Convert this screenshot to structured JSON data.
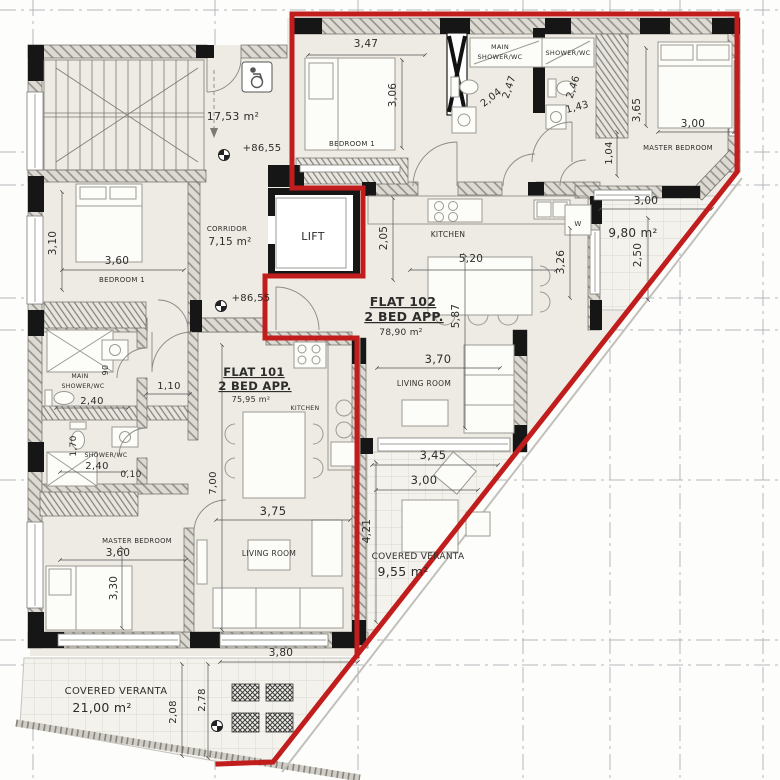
{
  "flats": [
    {
      "name": "FLAT 101",
      "type": "2 BED APP.",
      "area": "75,95 m²",
      "highlighted": false
    },
    {
      "name": "FLAT 102",
      "type": "2 BED APP.",
      "area": "78,90 m²",
      "highlighted": true
    }
  ],
  "common": {
    "lift": "LIFT",
    "corridor": "CORRIDOR",
    "corridor_area": "7,15 m²",
    "stairs_area": "17,53 m²",
    "level_marks": [
      "+86,55",
      "+86,55"
    ]
  },
  "verandas": [
    {
      "label": "COVERED VERANTA",
      "area": "21,00 m²"
    },
    {
      "label": "COVERED VERANTA",
      "area": "9,55 m²"
    },
    {
      "label": "",
      "area": "9,80 m²"
    }
  ],
  "red": {
    "color": "#c21d1d",
    "outline_main": "292,14 737,14 737,172 273,762 218,764",
    "outline_left": "292,14 292,188 363,188 363,276 265,276 265,338 357,338 357,656"
  },
  "labels": [
    {
      "n": "stairs-area",
      "t": "17,53 m²",
      "x": 233,
      "y": 120,
      "s": 11
    },
    {
      "n": "level-mark-top",
      "t": "+86,55",
      "x": 262,
      "y": 151,
      "s": 10
    },
    {
      "n": "corridor-label",
      "t": "CORRIDOR",
      "x": 227,
      "y": 231,
      "s": 7
    },
    {
      "n": "corridor-area",
      "t": "7,15 m²",
      "x": 230,
      "y": 245,
      "s": 10.5
    },
    {
      "n": "level-mark-corridor",
      "t": "+86,55",
      "x": 251,
      "y": 301,
      "s": 10
    },
    {
      "n": "lift-label",
      "t": "LIFT",
      "x": 313,
      "y": 240,
      "s": 11
    },
    {
      "n": "dim",
      "t": "3,47",
      "x": 366,
      "y": 47,
      "s": 10.5
    },
    {
      "n": "f102-bedroom1",
      "t": "BEDROOM 1",
      "x": 352,
      "y": 146,
      "s": 7
    },
    {
      "n": "dim",
      "t": "3,06",
      "x": 396,
      "y": 95,
      "s": 10.5,
      "r": -90
    },
    {
      "n": "f102-main-shower-1",
      "t": "MAIN",
      "x": 500,
      "y": 49,
      "s": 6.5
    },
    {
      "n": "f102-main-shower-2",
      "t": "SHOWER/WC",
      "x": 500,
      "y": 59,
      "s": 6.5
    },
    {
      "n": "dim",
      "t": "2,04",
      "x": 493,
      "y": 100,
      "s": 10,
      "r": -38
    },
    {
      "n": "dim",
      "t": "2,47",
      "x": 512,
      "y": 88,
      "s": 10,
      "r": -72
    },
    {
      "n": "f102-shower",
      "t": "SHOWER/WC",
      "x": 568,
      "y": 55,
      "s": 6.5
    },
    {
      "n": "dim",
      "t": "2,46",
      "x": 576,
      "y": 88,
      "s": 10,
      "r": -72
    },
    {
      "n": "dim",
      "t": "1,43",
      "x": 578,
      "y": 110,
      "s": 10,
      "r": -15
    },
    {
      "n": "dim",
      "t": "3,65",
      "x": 640,
      "y": 110,
      "s": 10.5,
      "r": -90
    },
    {
      "n": "dim",
      "t": "3,00",
      "x": 693,
      "y": 127,
      "s": 10.5
    },
    {
      "n": "f102-master-bedroom",
      "t": "MASTER BEDROOM",
      "x": 678,
      "y": 150,
      "s": 6.8
    },
    {
      "n": "dim",
      "t": "1,04",
      "x": 612,
      "y": 153,
      "s": 10,
      "r": -90
    },
    {
      "n": "dim",
      "t": "3,00",
      "x": 646,
      "y": 204,
      "s": 10.5
    },
    {
      "n": "boiler",
      "t": "W",
      "x": 578,
      "y": 226,
      "s": 7
    },
    {
      "n": "veranda-980-area",
      "t": "9,80 m²",
      "x": 633,
      "y": 237,
      "s": 12
    },
    {
      "n": "dim",
      "t": "2,50",
      "x": 641,
      "y": 255,
      "s": 10.5,
      "r": -90
    },
    {
      "n": "f102-kitchen",
      "t": "KITCHEN",
      "x": 448,
      "y": 237,
      "s": 7.5
    },
    {
      "n": "dim",
      "t": "5,20",
      "x": 471,
      "y": 262,
      "s": 10.5
    },
    {
      "n": "dim",
      "t": "2,05",
      "x": 387,
      "y": 238,
      "s": 10.5,
      "r": -90
    },
    {
      "n": "dim",
      "t": "3,26",
      "x": 564,
      "y": 262,
      "s": 10.5,
      "r": -90
    },
    {
      "n": "flat102-name",
      "t": "FLAT 102",
      "x": 403,
      "y": 306,
      "s": 12.5,
      "b": 1,
      "u": 1
    },
    {
      "n": "flat102-type",
      "t": "2 BED APP.",
      "x": 404,
      "y": 321,
      "s": 12.5,
      "b": 1,
      "u": 1
    },
    {
      "n": "flat102-area",
      "t": "78,90 m²",
      "x": 401,
      "y": 335,
      "s": 9
    },
    {
      "n": "dim",
      "t": "5,87",
      "x": 459,
      "y": 316,
      "s": 10.5,
      "r": -90
    },
    {
      "n": "dim",
      "t": "3,70",
      "x": 438,
      "y": 363,
      "s": 11.5
    },
    {
      "n": "f102-living-room",
      "t": "LIVING ROOM",
      "x": 424,
      "y": 386,
      "s": 7.5
    },
    {
      "n": "dim",
      "t": "3,45",
      "x": 433,
      "y": 459,
      "s": 11.5
    },
    {
      "n": "dim",
      "t": "3,00",
      "x": 424,
      "y": 484,
      "s": 11.5
    },
    {
      "n": "dim",
      "t": "4,21",
      "x": 370,
      "y": 531,
      "s": 10.5,
      "r": -90
    },
    {
      "n": "veranda-955-label",
      "t": "COVERED VERANTA",
      "x": 418,
      "y": 559,
      "s": 9
    },
    {
      "n": "veranda-955-area",
      "t": "9,55 m²",
      "x": 403,
      "y": 576,
      "s": 12.5
    },
    {
      "n": "dim",
      "t": "3,10",
      "x": 56,
      "y": 243,
      "s": 10.5,
      "r": -90
    },
    {
      "n": "dim",
      "t": "3,60",
      "x": 117,
      "y": 264,
      "s": 10.5
    },
    {
      "n": "f101-bedroom1",
      "t": "BEDROOM 1",
      "x": 122,
      "y": 282,
      "s": 7
    },
    {
      "n": "f101-main-shower-1",
      "t": "MAIN",
      "x": 80,
      "y": 378,
      "s": 6.2
    },
    {
      "n": "f101-main-shower-2",
      "t": "SHOWER/WC",
      "x": 83,
      "y": 388,
      "s": 6.2
    },
    {
      "n": "dim",
      "t": "2,40",
      "x": 92,
      "y": 404,
      "s": 10
    },
    {
      "n": "dim",
      "t": "90",
      "x": 108,
      "y": 370,
      "s": 8,
      "r": -90
    },
    {
      "n": "dim",
      "t": "1,10",
      "x": 169,
      "y": 389,
      "s": 10
    },
    {
      "n": "dim",
      "t": "1,70",
      "x": 76,
      "y": 446,
      "s": 9,
      "r": -90
    },
    {
      "n": "f101-shower",
      "t": "SHOWER/WC",
      "x": 106,
      "y": 457,
      "s": 6.2
    },
    {
      "n": "dim",
      "t": "2,40",
      "x": 97,
      "y": 469,
      "s": 10
    },
    {
      "n": "dim",
      "t": "0,10",
      "x": 131,
      "y": 477,
      "s": 9
    },
    {
      "n": "flat101-name",
      "t": "FLAT 101",
      "x": 254,
      "y": 376,
      "s": 11.5,
      "b": 1,
      "u": 1
    },
    {
      "n": "flat101-type",
      "t": "2 BED APP.",
      "x": 255,
      "y": 390,
      "s": 11.5,
      "b": 1,
      "u": 1
    },
    {
      "n": "flat101-area",
      "t": "75,95 m²",
      "x": 251,
      "y": 402,
      "s": 8
    },
    {
      "n": "f101-kitchen",
      "t": "KITCHEN",
      "x": 305,
      "y": 410,
      "s": 6.2
    },
    {
      "n": "dim",
      "t": "7,00",
      "x": 216,
      "y": 483,
      "s": 10,
      "r": -90
    },
    {
      "n": "f101-master-bedroom",
      "t": "MASTER BEDROOM",
      "x": 137,
      "y": 543,
      "s": 6.8
    },
    {
      "n": "dim",
      "t": "3,60",
      "x": 118,
      "y": 556,
      "s": 10.5
    },
    {
      "n": "dim",
      "t": "3,30",
      "x": 117,
      "y": 588,
      "s": 10.5,
      "r": -90
    },
    {
      "n": "dim",
      "t": "3,75",
      "x": 273,
      "y": 515,
      "s": 11.5
    },
    {
      "n": "f101-living-room",
      "t": "LIVING ROOM",
      "x": 269,
      "y": 556,
      "s": 7.5
    },
    {
      "n": "dim",
      "t": "3,80",
      "x": 281,
      "y": 656,
      "s": 10.5
    },
    {
      "n": "veranda-21-label",
      "t": "COVERED VERANTA",
      "x": 116,
      "y": 694,
      "s": 10
    },
    {
      "n": "veranda-21-area",
      "t": "21,00 m²",
      "x": 102,
      "y": 712,
      "s": 12.5
    },
    {
      "n": "dim",
      "t": "2,08",
      "x": 176,
      "y": 712,
      "s": 10,
      "r": -90
    },
    {
      "n": "dim",
      "t": "2,78",
      "x": 205,
      "y": 700,
      "s": 10,
      "r": -90
    }
  ]
}
